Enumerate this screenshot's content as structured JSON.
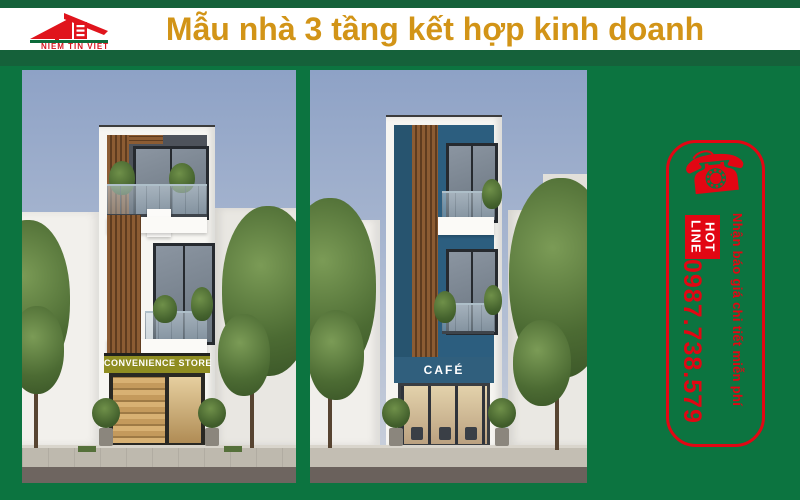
{
  "header": {
    "brand_name": "NIEM TIN VIET",
    "title": "Mẫu nhà 3 tầng kết hợp kinh doanh"
  },
  "gallery": {
    "left_photo": {
      "sign": "CONVENIENCE STORE"
    },
    "right_photo": {
      "sign": "CAFÉ"
    }
  },
  "hotline": {
    "phone_glyph": "☎",
    "label_line1": "HOT",
    "label_line2": "LINE",
    "phone": "0987.738.579",
    "note": "Nhận báo giá chi tiết miễn phí"
  },
  "colors": {
    "green_background": "#0c7440",
    "green_stripe": "#15613a",
    "red_accent": "#e20613",
    "gold_title": "#d29417",
    "olive_sign": "#8f8d22",
    "teal_facade": "#2e5f7e"
  }
}
